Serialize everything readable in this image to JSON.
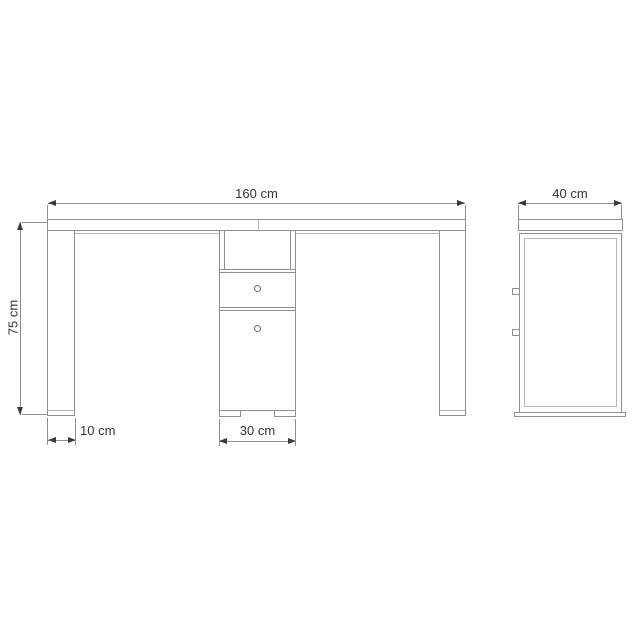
{
  "drawing": {
    "description": "Technical dimension drawing of a desk with pedestal drawer unit, front view and side view",
    "front_view": {
      "dim_width_label": "160 cm",
      "dim_height_label": "75 cm",
      "dim_leg_label": "10 cm",
      "dim_cabinet_label": "30 cm"
    },
    "side_view": {
      "dim_depth_label": "40 cm"
    }
  },
  "colors": {
    "background": "#ffffff",
    "line": "#8f8f8f",
    "line_light": "#b6b6b6",
    "text": "#333333",
    "arrow": "#3a3a3a"
  }
}
